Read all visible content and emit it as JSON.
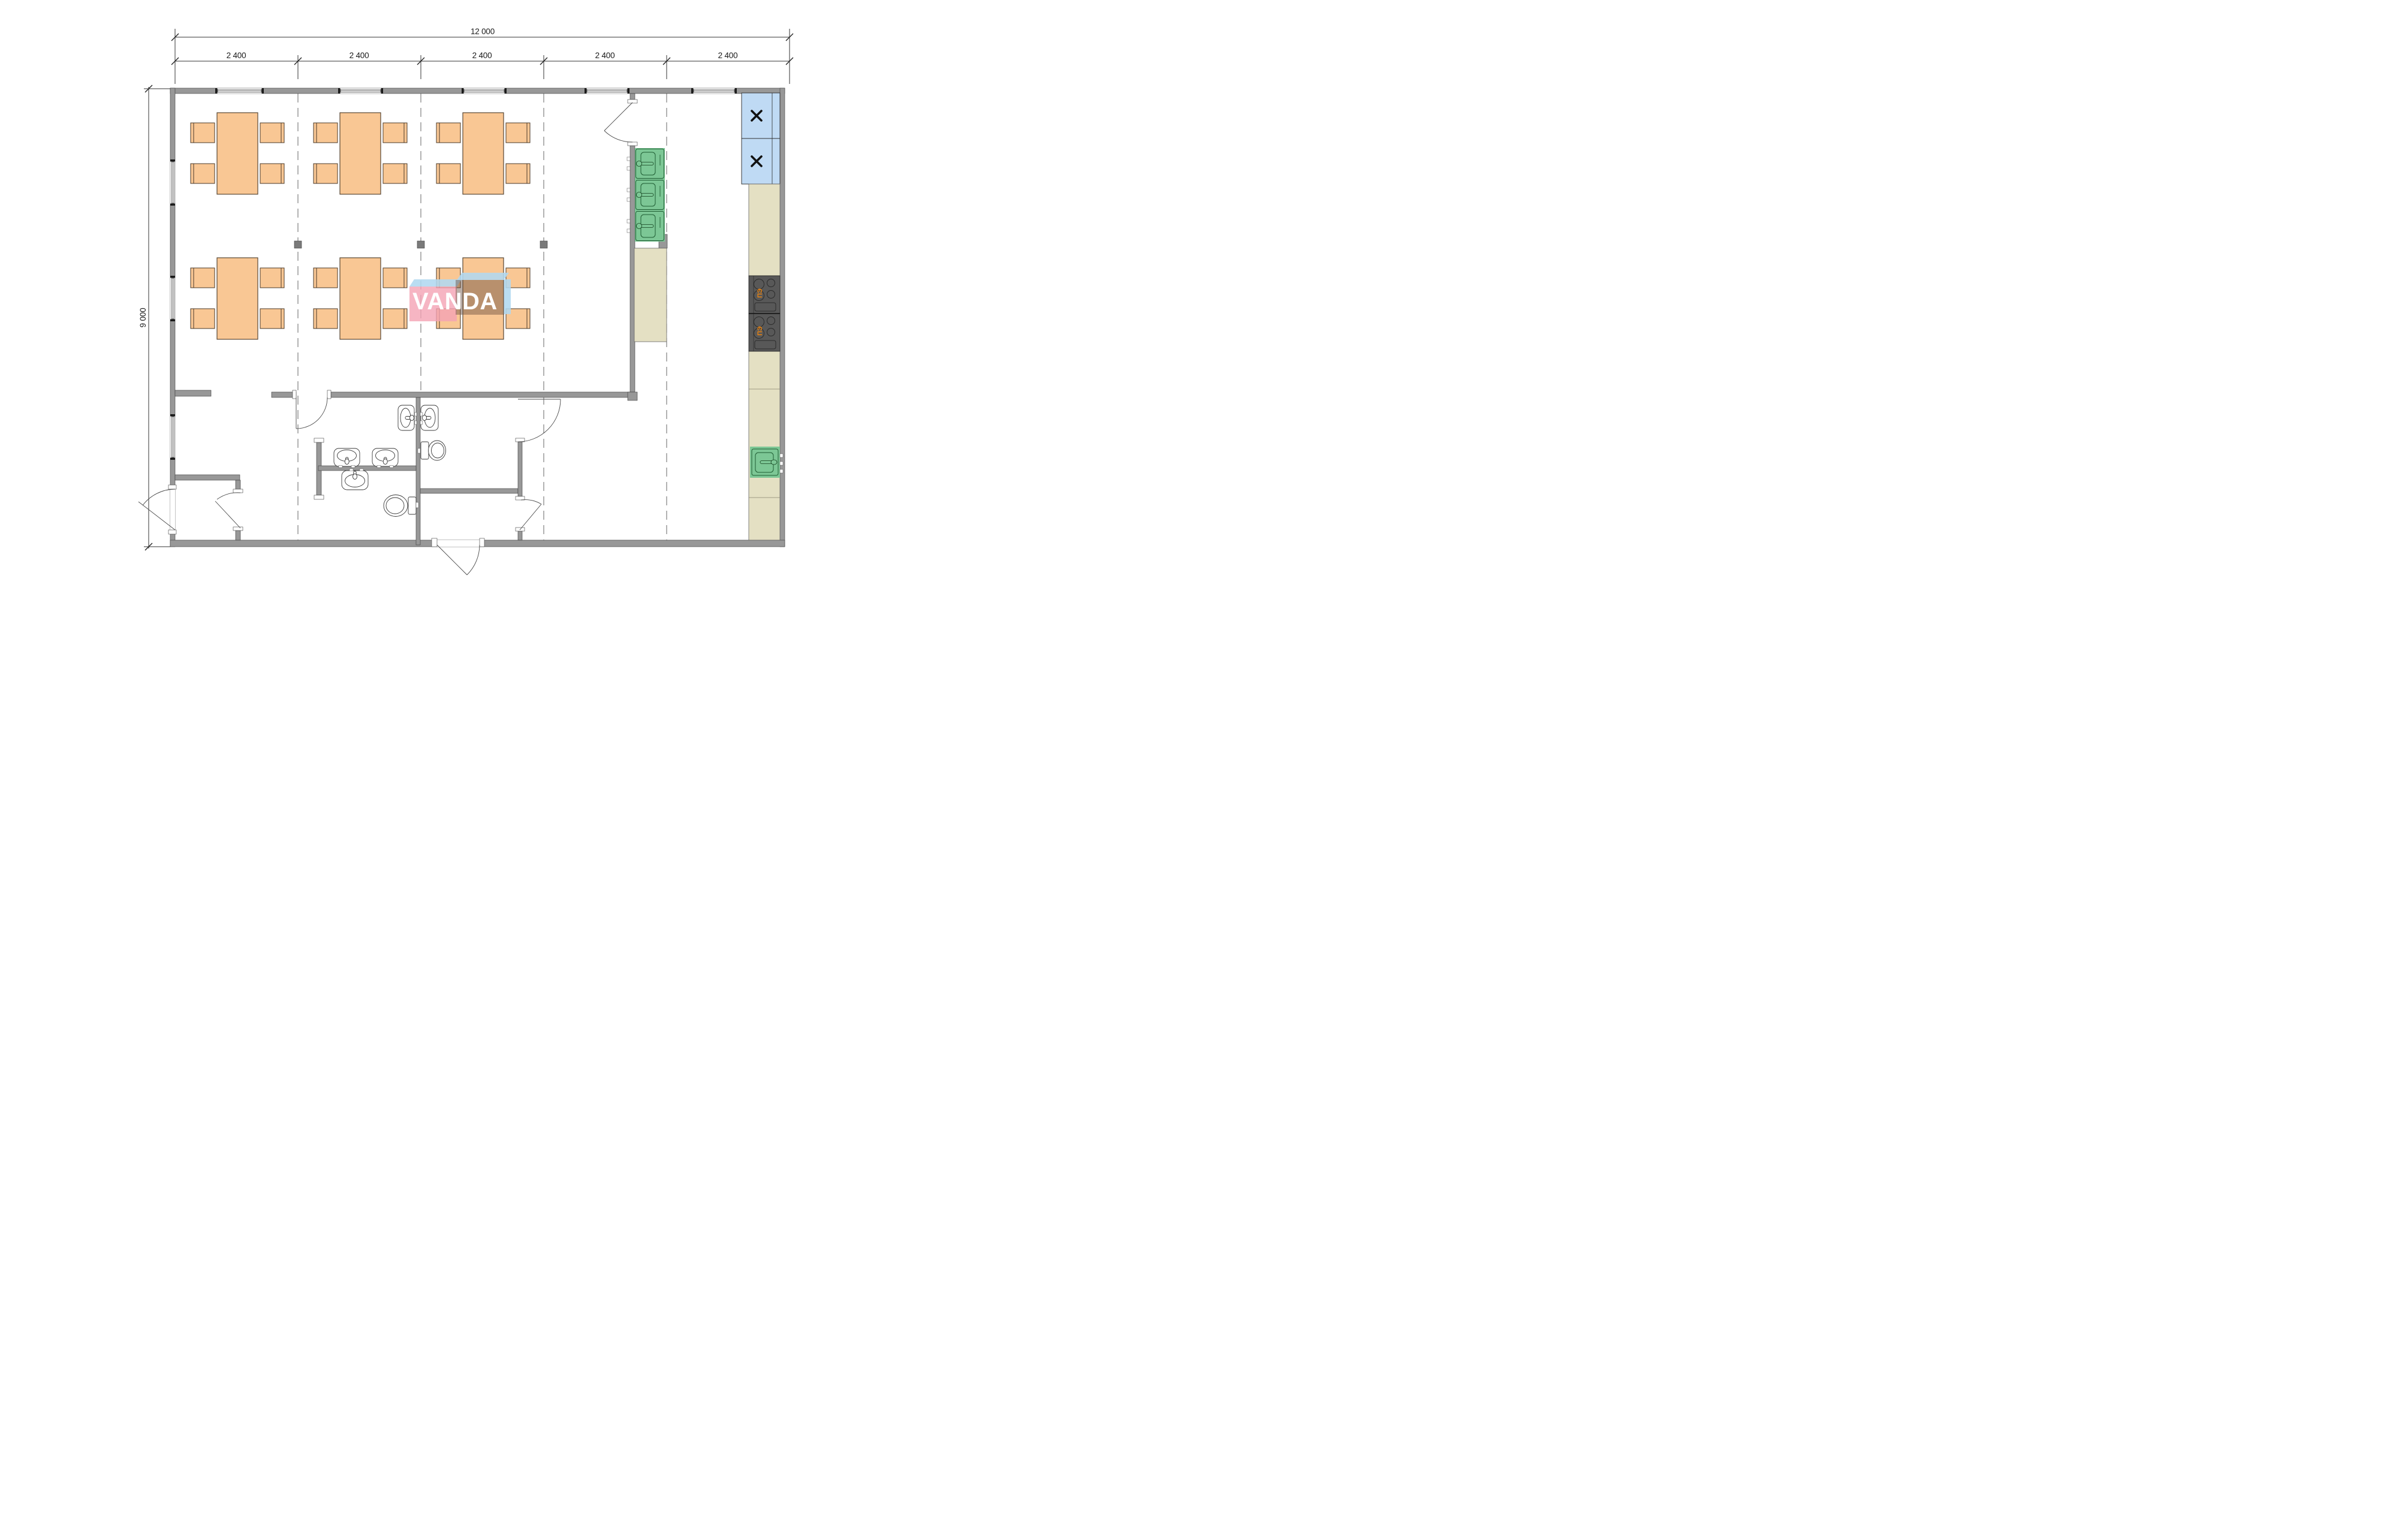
{
  "document": {
    "type": "architectural floor plan",
    "watermark_text": "VANDA"
  },
  "dimensions": {
    "overall_width_label": "12 000",
    "module_labels": [
      "2 400",
      "2 400",
      "2 400",
      "2 400",
      "2 400"
    ],
    "overall_height_label": "9 000"
  },
  "kitchen": {
    "stove_label": "ПЭ"
  },
  "colors": {
    "wall_gray": "#989898",
    "furniture_orange": "#F9C794",
    "sink_green": "#7CC795",
    "cabinet_blue": "#BFDAF4",
    "counter_tan": "#E4E0C3",
    "stove_dark": "#585858",
    "stove_label_orange": "#E8820F",
    "watermark_pink": "#F4A3B4",
    "watermark_blue": "#B0D8F0",
    "watermark_letters": "#FFFFFF"
  }
}
